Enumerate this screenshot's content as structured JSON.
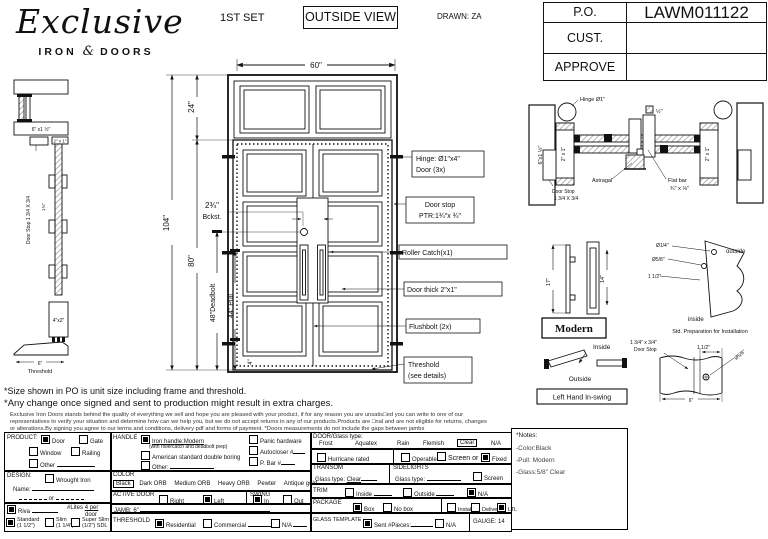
{
  "header": {
    "logo": {
      "script": "Exclusive",
      "iron": "IRON",
      "amp": "&",
      "doors": "DOORS"
    },
    "set_label": "1ST SET",
    "view_label": "OUTSIDE VIEW",
    "drawn_label": "DRAWN: ZA",
    "po": {
      "r0l": "P.O.",
      "r0v": "LAWM011122",
      "r1l": "CUST.",
      "r1v": "",
      "r2l": "APPROVE",
      "r2v": ""
    }
  },
  "elevation": {
    "w": "60\"",
    "transom_h": "24\"",
    "total_h": "104\"",
    "door_h": "80\"",
    "deadbolt": "48\"Deadbolt",
    "pull": "44\" Pull",
    "backset1": "2¾\"",
    "backset2": "Bckst.",
    "bottom_rail": "4\"",
    "co_hinge1": "Hinge: Ø1\"x4\"",
    "co_hinge2": "Door (3x)",
    "co_stop1": "Door stop",
    "co_stop2": "PTR:1¾\"x ¾\"",
    "co_roller": "Roller Catch(x1)",
    "co_thick": "Door thick 2\"x1\"",
    "co_flush": "Flushbolt (2x)",
    "co_thresh1": "Threshold",
    "co_thresh2": "(see details)"
  },
  "jamb_section": {
    "top_label": "6\" x1 ½\"",
    "bar_label": "2\" x 1\"",
    "stop_label": "Door Stop 1 3/4 X 3/4",
    "mid_dim": "1¾\"",
    "block_label": "4\"x2\"",
    "thresh_dim": "6\"",
    "thresh_label": "Threshold"
  },
  "plan_section": {
    "hinge": "Hinge Ø1\"",
    "left_jamb": "6\"x1 ½\"",
    "bar_l": "2\" x 1\"",
    "bar_r": "2\" x 1\"",
    "stop1": "Door Stop",
    "stop2": "1 3/4 X 3/4",
    "astragal": "Astragal",
    "flat1": "Flat bar",
    "flat2": "¾\" x ⅛\"",
    "half": "½\""
  },
  "handle_detail": {
    "d17": "17\"",
    "d14": "14\"",
    "label": "Modern"
  },
  "prep_detail": {
    "d1": "Ø1/4\"",
    "d2": "Ø5/8\"",
    "d3": "1 1/2\"",
    "outside": "outside",
    "inside": "inside",
    "caption": "Std. Preparation for Installation"
  },
  "swing_detail": {
    "inside": "Inside",
    "outside": "Outside",
    "label": "Left Hand In-swing"
  },
  "stop_detail": {
    "l1": "1 3/4\" x 3/4\"",
    "l2": "Door Stop",
    "d1": "1 1/2\"",
    "d2": "Ø5/8\"",
    "d3": "6\""
  },
  "disclaimer": {
    "l1": "*Size shown in PO is unit size including frame and threshold.",
    "l2": "*Any change once signed and sent to production might result in extra charges.",
    "f1": "Exclusive Iron Doors stands behind the quality of everything we sell and hope you are pleased with your product, if for any reason you are unsatis□ed you can write to one of our",
    "f2": "representatives to verify your situation and determine how can we help you, but we do not accept returns in any of our products.Products are □nal and are not eligible for returns, changes",
    "f3": "or alterations.By signing you agree to our terms and conditions, delivery pdf and forms of payment. *Doors measurements do not include the gaps between jambs"
  },
  "form": {
    "product": {
      "label": "PRODUCT:",
      "opts": [
        {
          "t": "Door",
          "c": true
        },
        {
          "t": "Gate",
          "c": false
        },
        {
          "t": "Window",
          "c": false
        },
        {
          "t": "Railing",
          "c": false
        },
        {
          "t": "Other",
          "c": false
        }
      ]
    },
    "design": {
      "label": "DESIGN:",
      "wrought": {
        "t": "Wrought Iron",
        "c": false
      },
      "name_label": "Name:",
      "or": "or"
    },
    "riva": {
      "t": "Riva",
      "c": true
    },
    "lites": {
      "label": "#Lites",
      "value": "4 per",
      "unit": "door"
    },
    "thickness": [
      {
        "t": "Standard",
        "s": "(1 1/2\")",
        "c": true
      },
      {
        "t": "Slim",
        "s": "(1 1/4\")",
        "c": false
      },
      {
        "t": "Super Slim",
        "s": "(1/2\") SDL",
        "c": false
      }
    ],
    "handle": {
      "label": "HANDLE",
      "opts": [
        {
          "t": "Iron handle:Modern",
          "c": true
        },
        {
          "t": "American standard double boring",
          "c": false
        },
        {
          "t": "Other:",
          "c": false
        }
      ],
      "sub": "(with rollercatch and deadbolt prep)",
      "extras": [
        {
          "t": "Panic hardware",
          "c": false
        },
        {
          "t": "Autocloser #",
          "c": false
        },
        {
          "t": "P. Bar #",
          "c": false
        }
      ]
    },
    "color": {
      "label": "COLOR",
      "selected": "Black",
      "opts": [
        "Dark ORB",
        "Medium ORB",
        "Heavy ORB",
        "Pewter",
        "Antique gold"
      ]
    },
    "active_door": {
      "label": "ACTIVE DOOR",
      "opts": [
        {
          "t": "Right",
          "c": false
        },
        {
          "t": "Left",
          "c": true
        }
      ]
    },
    "swing": {
      "label": "SWING",
      "opts": [
        {
          "t": "In",
          "c": true
        },
        {
          "t": "Out",
          "c": false
        }
      ]
    },
    "jamb": {
      "label": "JAMB:",
      "value": "6\""
    },
    "threshold": {
      "label": "THRESHOLD",
      "opts": [
        {
          "t": "Residential",
          "c": true
        },
        {
          "t": "Commercial",
          "c": false
        },
        {
          "t": "N/A",
          "c": false
        }
      ]
    },
    "glass": {
      "label": "DOOR/Glass type:",
      "types": [
        "Frost",
        "Aquatex",
        "Rain",
        "Flemish"
      ],
      "selected": "Clear",
      "na": "N/A",
      "hurricane": {
        "t": "Hurricane rated",
        "c": false
      },
      "operable": {
        "t": "Operable",
        "c": false
      },
      "screen_or": {
        "t": "Screen or",
        "c": false
      },
      "fixed": {
        "t": "Fixed",
        "c": true
      }
    },
    "transom": {
      "label": "TRANSOM",
      "glass_label": "Glass type:",
      "value": "Clear"
    },
    "sidelights": {
      "label": "SIDELIGHTS",
      "glass_label": "Glass type:",
      "screen": {
        "t": "Screen",
        "c": false
      }
    },
    "trim": {
      "label": "TRIM",
      "opts": [
        {
          "t": "Inside",
          "c": false
        },
        {
          "t": "Outside",
          "c": false
        },
        {
          "t": "N/A",
          "c": true
        }
      ]
    },
    "package": {
      "label": "PACKAGE",
      "opts": [
        {
          "t": "Box",
          "c": true
        },
        {
          "t": "No box",
          "c": false
        },
        {
          "t": "Install",
          "c": false
        },
        {
          "t": "Delivery",
          "c": false
        },
        {
          "t": "LTL",
          "c": true
        }
      ]
    },
    "glass_template": {
      "label": "GLASS TEMPLATE",
      "opts": [
        {
          "t": "Sent #Pieces:",
          "c": true
        },
        {
          "t": "N/A",
          "c": false
        }
      ],
      "gauge": "GAUGE: 14"
    },
    "notes": {
      "title": "*Notes:",
      "lines": [
        "-Color:Black",
        "-Pull: Modern",
        "-Glass:5/8\" Clear"
      ]
    }
  }
}
